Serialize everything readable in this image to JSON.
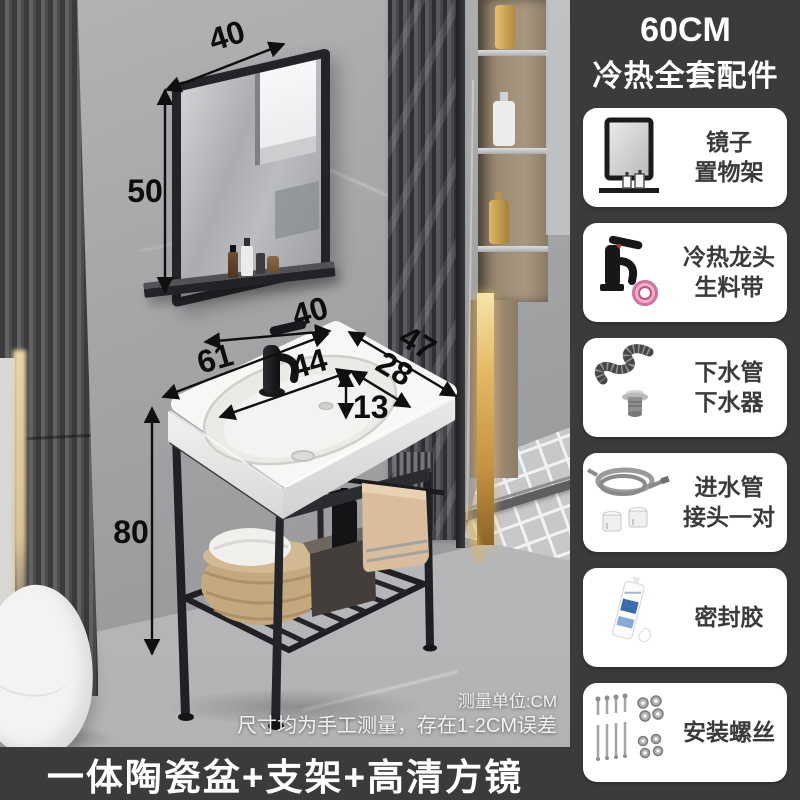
{
  "sidebar": {
    "title_line1": "60CM",
    "title_line2": "冷热全套配件",
    "items": [
      {
        "icon": "mirror-shelf-icon",
        "line1": "镜子",
        "line2": "置物架"
      },
      {
        "icon": "faucet-tape-icon",
        "line1": "冷热龙头",
        "line2": "生料带"
      },
      {
        "icon": "drain-pipe-icon",
        "line1": "下水管",
        "line2": "下水器"
      },
      {
        "icon": "inlet-hose-icon",
        "line1": "进水管",
        "line2": "接头一对"
      },
      {
        "icon": "sealant-icon",
        "line1": "密封胶",
        "line2": ""
      },
      {
        "icon": "screws-icon",
        "line1": "安装螺丝",
        "line2": ""
      }
    ]
  },
  "banner": {
    "text": "一体陶瓷盆+支架+高清方镜"
  },
  "notes": {
    "line1": "测量单位:CM",
    "line2": "尺寸均为手工测量，存在1-2CM误差"
  },
  "dimensions": {
    "mirror_width": "40",
    "mirror_height": "50",
    "shelf_width": "40",
    "basin_width": "61",
    "basin_depth": "47",
    "bowl_width": "44",
    "bowl_depth": "28",
    "bowl_height": "13",
    "stand_height": "80"
  },
  "colors": {
    "panel_bg": "#3b3b3c",
    "card_bg": "#ffffff",
    "label_text": "#3b3b3b",
    "dim_text": "#0d0d0d",
    "tape_pink": "#f0afc9",
    "gold_accent": "#e0b660",
    "towel_beige": "#d9bd9d"
  }
}
